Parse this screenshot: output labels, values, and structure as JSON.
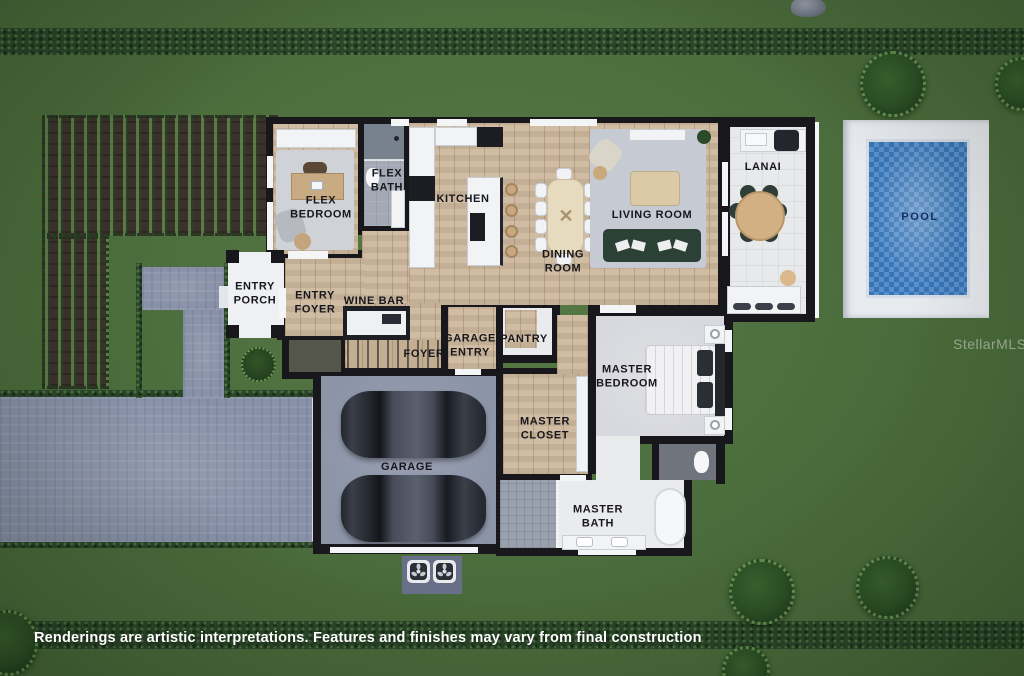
{
  "scene": {
    "type": "floor-plan-rendering",
    "watermark": "StellarMLS",
    "disclaimer": "Renderings are artistic interpretations. Features and finishes may vary from final construction"
  },
  "rooms": {
    "flex_bedroom": "FLEX BEDROOM",
    "flex_bath": "FLEX BATH",
    "kitchen": "KITCHEN",
    "dining_room": "DINING ROOM",
    "living_room": "LIVING ROOM",
    "lanai": "LANAI",
    "pool": "POOL",
    "entry_porch": "ENTRY PORCH",
    "entry_foyer": "ENTRY FOYER",
    "wine_bar": "WINE BAR",
    "foyer": "FOYER",
    "garage_entry": "GARAGE ENTRY",
    "pantry": "PANTRY",
    "master_bedroom": "MASTER BEDROOM",
    "master_closet": "MASTER CLOSET",
    "garage": "GARAGE",
    "master_bath": "MASTER BATH"
  },
  "colors": {
    "grass": "#4c6e3d",
    "hedge": "#2a4529",
    "driveway_pavers": "#8891a8",
    "wall": "#17171c",
    "wood_floor": "#cdb89d",
    "pool_water": "#3d7ec2",
    "pool_deck": "#e7eaef",
    "garage_floor": "#8c94a8",
    "label_text": "#17171d",
    "disclaimer_text": "#ffffff"
  },
  "icons": {
    "ac_fan": "three-blade condenser fan",
    "grill": "outdoor bbq grill"
  }
}
